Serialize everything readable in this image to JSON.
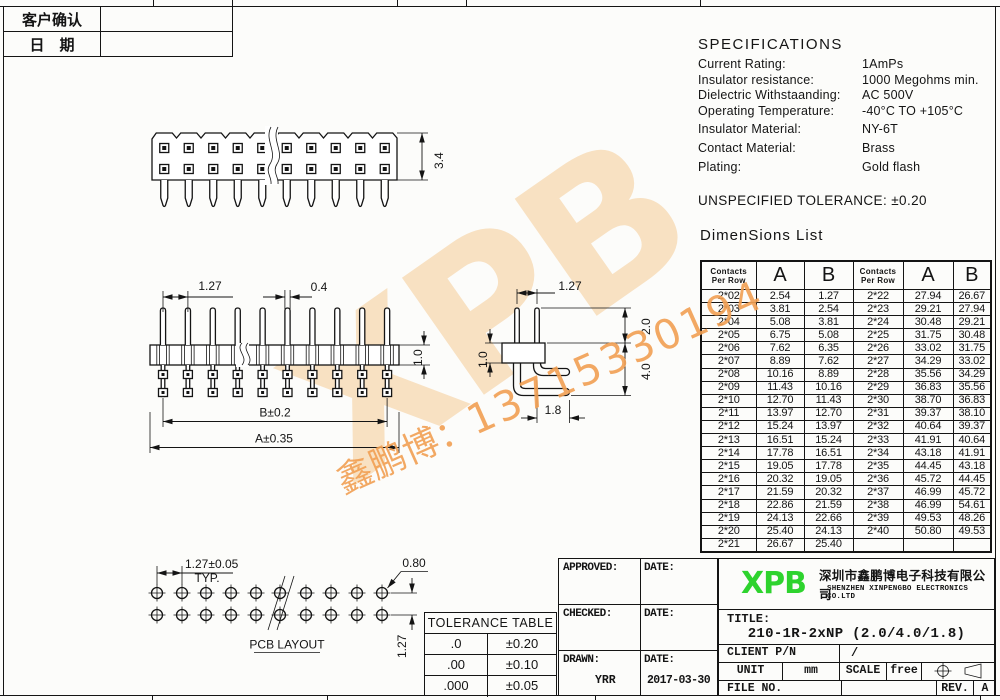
{
  "client_table": {
    "rows": [
      {
        "label": "客户确认",
        "value": ""
      },
      {
        "label": "日　期",
        "value": ""
      }
    ]
  },
  "specifications": {
    "title": "SPECIFICATIONS",
    "items": [
      {
        "label": "Current Rating:",
        "value": "1AmPs"
      },
      {
        "label": "Insulator resistance:",
        "value": "1000 Megohms min."
      },
      {
        "label": "Dielectric Withstaanding:",
        "value": "AC 500V"
      },
      {
        "label": "Operating Temperature:",
        "value": "-40°C TO +105°C"
      },
      {
        "label": "Insulator Material:",
        "value": "NY-6T"
      },
      {
        "label": "Contact Material:",
        "value": "Brass"
      },
      {
        "label": "Plating:",
        "value": "Gold flash"
      }
    ]
  },
  "unspecified_tolerance": "UNSPECIFIED TOLERANCE: ±0.20",
  "dimensions_list": {
    "title": "DimenSions List",
    "contacts_header_line1": "Contacts",
    "contacts_header_line2": "Per Row",
    "col_a": "A",
    "col_b": "B",
    "rows": [
      [
        "2*02",
        "2.54",
        "1.27",
        "2*22",
        "27.94",
        "26.67"
      ],
      [
        "2*03",
        "3.81",
        "2.54",
        "2*23",
        "29.21",
        "27.94"
      ],
      [
        "2*04",
        "5.08",
        "3.81",
        "2*24",
        "30.48",
        "29.21"
      ],
      [
        "2*05",
        "6.75",
        "5.08",
        "2*25",
        "31.75",
        "30.48"
      ],
      [
        "2*06",
        "7.62",
        "6.35",
        "2*26",
        "33.02",
        "31.75"
      ],
      [
        "2*07",
        "8.89",
        "7.62",
        "2*27",
        "34.29",
        "33.02"
      ],
      [
        "2*08",
        "10.16",
        "8.89",
        "2*28",
        "35.56",
        "34.29"
      ],
      [
        "2*09",
        "11.43",
        "10.16",
        "2*29",
        "36.83",
        "35.56"
      ],
      [
        "2*10",
        "12.70",
        "11.43",
        "2*30",
        "38.70",
        "36.83"
      ],
      [
        "2*11",
        "13.97",
        "12.70",
        "2*31",
        "39.37",
        "38.10"
      ],
      [
        "2*12",
        "15.24",
        "13.97",
        "2*32",
        "40.64",
        "39.37"
      ],
      [
        "2*13",
        "16.51",
        "15.24",
        "2*33",
        "41.91",
        "40.64"
      ],
      [
        "2*14",
        "17.78",
        "16.51",
        "2*34",
        "43.18",
        "41.91"
      ],
      [
        "2*15",
        "19.05",
        "17.78",
        "2*35",
        "44.45",
        "43.18"
      ],
      [
        "2*16",
        "20.32",
        "19.05",
        "2*36",
        "45.72",
        "44.45"
      ],
      [
        "2*17",
        "21.59",
        "20.32",
        "2*37",
        "46.99",
        "45.72"
      ],
      [
        "2*18",
        "22.86",
        "21.59",
        "2*38",
        "46.99",
        "54.61"
      ],
      [
        "2*19",
        "24.13",
        "22.66",
        "2*39",
        "49.53",
        "48.26"
      ],
      [
        "2*20",
        "25.40",
        "24.13",
        "2*40",
        "50.80",
        "49.53"
      ],
      [
        "2*21",
        "26.67",
        "25.40",
        "",
        "",
        ""
      ]
    ]
  },
  "drawings": {
    "top_view": {
      "dim_height": "3.4"
    },
    "front_view": {
      "dim_pitch": "1.27",
      "dim_pin": "0.4",
      "dim_body": "1.0",
      "dim_b": "B±0.2",
      "dim_a": "A±0.35"
    },
    "side_view": {
      "dim_pitch": "1.27",
      "dim_top": "2.0",
      "dim_body": "1.0",
      "dim_tail": "4.0",
      "dim_foot": "1.8"
    },
    "pcb": {
      "dim_pitch": "1.27±0.05",
      "typ": "TYP.",
      "dim_hole": "0.80",
      "dim_row": "1.27",
      "label": "PCB LAYOUT"
    }
  },
  "tolerance_table": {
    "title": "TOLERANCE TABLE",
    "rows": [
      {
        "digits": ".0",
        "tol": "±0.20"
      },
      {
        "digits": ".00",
        "tol": "±0.10"
      },
      {
        "digits": ".000",
        "tol": "±0.05"
      }
    ]
  },
  "title_block": {
    "approved_label": "APPROVED:",
    "approved_date_label": "DATE:",
    "checked_label": "CHECKED:",
    "checked_date_label": "DATE:",
    "drawn_label": "DRAWN:",
    "drawn_value": "YRR",
    "drawn_date_label": "DATE:",
    "drawn_date_value": "2017-03-30",
    "logo": "XPB",
    "logo_color": "#2ed32e",
    "company_cn": "深圳市鑫鹏博电子科技有限公司",
    "company_en": "SHENZHEN XINPENGBO ELECTRONICS CO.LTD",
    "title_label": "TITLE:",
    "title_value": "210-1R-2xNP (2.0/4.0/1.8)",
    "client_pn_label": "CLIENT P/N",
    "client_pn_value": "/",
    "unit_label": "UNIT",
    "unit_value": "mm",
    "scale_label": "SCALE",
    "scale_value": "free",
    "file_no_label": "FILE NO.",
    "rev_label": "REV.",
    "rev_value": "A"
  },
  "watermark": {
    "logo": "XPB",
    "text_cn": "鑫鹏博：",
    "phone": "13715330194",
    "logo_color": "#f5cb96",
    "text_color": "#f2a053"
  }
}
